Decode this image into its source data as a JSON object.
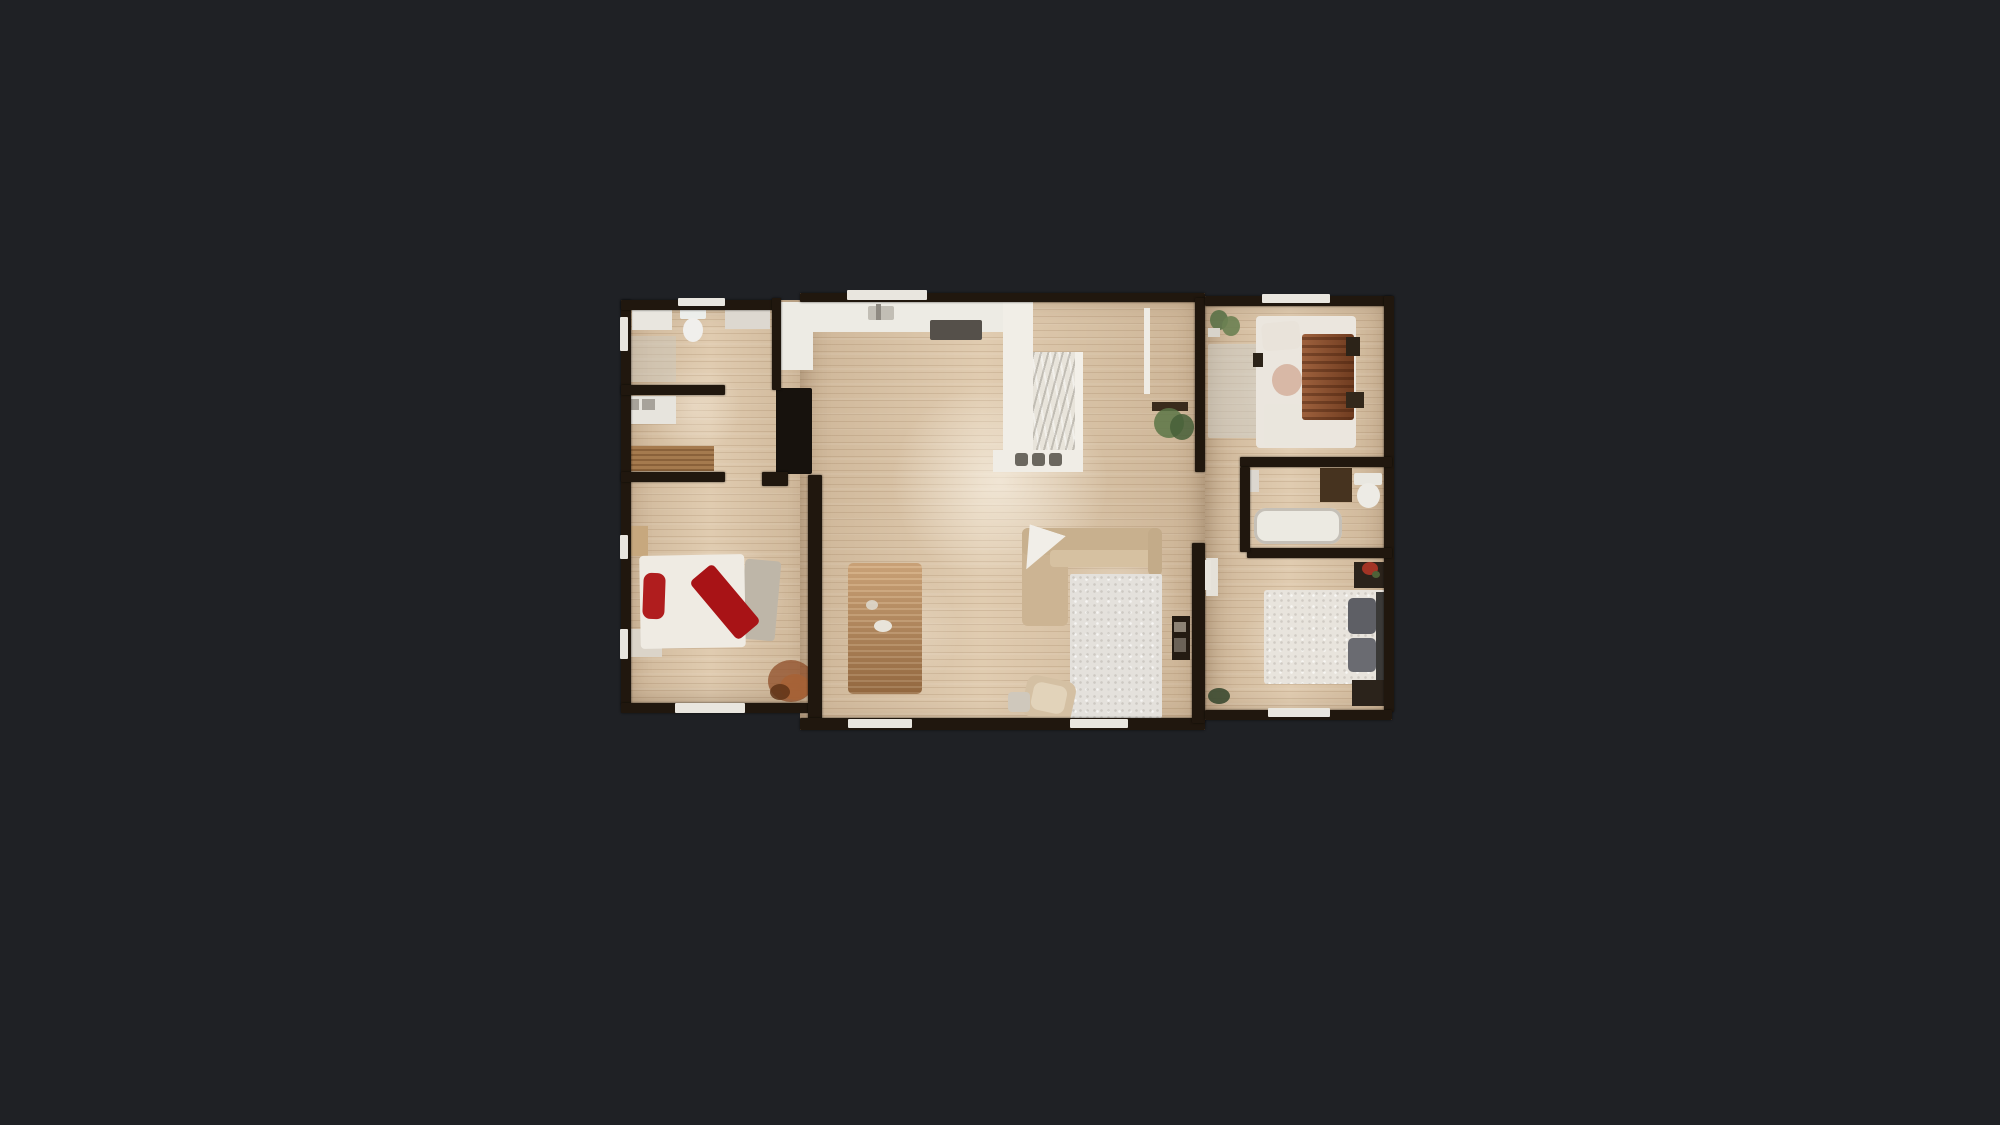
{
  "app": {
    "view": "floor-plan-top-down",
    "background_color": "#1f2125"
  },
  "colors": {
    "bg": "#1f2125",
    "wall": "#20170e",
    "floor": "#dcc6a9",
    "sill": "#e9e6df",
    "accent_red": "#b01d1e",
    "duvet_rust": "#8b4d2a",
    "sofa_beige": "#ccb493",
    "counter_white": "#edebe4"
  },
  "plan": {
    "x": 620,
    "y": 292,
    "w": 775,
    "h": 440
  },
  "scene": {
    "floors": [
      {
        "n": "floor-left-wing",
        "x": 1,
        "y": 8,
        "w": 198,
        "h": 405
      },
      {
        "n": "floor-center-wing",
        "x": 180,
        "y": 1,
        "w": 405,
        "h": 437
      },
      {
        "n": "floor-right-wing",
        "x": 585,
        "y": 4,
        "w": 187,
        "h": 424
      }
    ],
    "glares": [
      {
        "n": "glare-kitchen",
        "x": 230,
        "y": 50,
        "w": 300,
        "h": 280,
        "c": "rgba(255,252,244,0.55)"
      },
      {
        "n": "glare-living",
        "x": 420,
        "y": 220,
        "w": 160,
        "h": 160,
        "c": "rgba(255,250,240,0.35)"
      },
      {
        "n": "glare-bedroom-left",
        "x": 20,
        "y": 230,
        "w": 170,
        "h": 150,
        "c": "rgba(255,248,238,0.38)"
      },
      {
        "n": "glare-laundry",
        "x": 10,
        "y": 50,
        "w": 130,
        "h": 130,
        "c": "rgba(255,248,238,0.30)"
      },
      {
        "n": "glare-bedroom-top-right",
        "x": 595,
        "y": 30,
        "w": 170,
        "h": 130,
        "c": "rgba(255,248,238,0.32)"
      },
      {
        "n": "glare-bedroom-bottom-right",
        "x": 595,
        "y": 290,
        "w": 170,
        "h": 120,
        "c": "rgba(255,248,238,0.30)"
      },
      {
        "n": "glare-dining",
        "x": 210,
        "y": 260,
        "w": 150,
        "h": 160,
        "c": "rgba(255,248,238,0.25)"
      }
    ],
    "furniture": [
      {
        "n": "bathroom1-vanity",
        "x": 12,
        "y": 16,
        "w": 40,
        "h": 22,
        "c": "#e9e6df"
      },
      {
        "n": "toilet1-tank",
        "x": 60,
        "y": 14,
        "w": 26,
        "h": 13,
        "c": "#eceeeb",
        "r": 2
      },
      {
        "n": "toilet1-bowl",
        "x": 63,
        "y": 26,
        "w": 20,
        "h": 24,
        "c": "#f0efec",
        "shape": "ellipse"
      },
      {
        "n": "bathroom1-cabinet",
        "x": 105,
        "y": 13,
        "w": 45,
        "h": 24,
        "c": "#ddd8d0"
      },
      {
        "n": "bathroom1-mat",
        "x": 4,
        "y": 44,
        "w": 52,
        "h": 46,
        "c": "rgba(205,201,192,0.45)"
      },
      {
        "n": "laundry-counter",
        "x": 4,
        "y": 104,
        "w": 52,
        "h": 28,
        "c": "#e7e4dd"
      },
      {
        "n": "washer",
        "x": 6,
        "y": 107,
        "w": 13,
        "h": 11,
        "c": "#a7a29a"
      },
      {
        "n": "dryer",
        "x": 22,
        "y": 107,
        "w": 13,
        "h": 11,
        "c": "#a7a29a"
      },
      {
        "n": "laundry-bench",
        "x": 4,
        "y": 154,
        "w": 90,
        "h": 25,
        "c": "#a57a4e",
        "cls": "woodgrain"
      },
      {
        "n": "bed1-nightstand-top",
        "x": 4,
        "y": 234,
        "w": 24,
        "h": 30,
        "c": "#c7a87e"
      },
      {
        "n": "bed1-nightstand-bottom",
        "x": 10,
        "y": 337,
        "w": 32,
        "h": 28,
        "c": "#dbd4c9"
      },
      {
        "n": "bed1-foot-throw",
        "x": 122,
        "y": 268,
        "w": 36,
        "h": 80,
        "c": "#beb6a8",
        "rot": 5,
        "r": 4
      },
      {
        "n": "bed1-mattress",
        "x": 20,
        "y": 263,
        "w": 105,
        "h": 93,
        "c": "#efebe3",
        "r": 4,
        "rot": -1
      },
      {
        "n": "bed1-red-pillow",
        "x": 23,
        "y": 281,
        "w": 22,
        "h": 46,
        "c": "#b01d1e",
        "r": 8,
        "rot": 2
      },
      {
        "n": "bed1-red-blanket",
        "x": 90,
        "y": 272,
        "w": 30,
        "h": 76,
        "c": "#a81316",
        "r": 5,
        "rot": -40
      },
      {
        "n": "bed1-plant-a",
        "x": 148,
        "y": 368,
        "w": 46,
        "h": 42,
        "c": "#8f4d28",
        "shape": "ellipse",
        "op": 0.75
      },
      {
        "n": "bed1-plant-b",
        "x": 160,
        "y": 382,
        "w": 30,
        "h": 26,
        "c": "#a86234",
        "shape": "ellipse",
        "op": 0.8
      },
      {
        "n": "bed1-plant-c",
        "x": 150,
        "y": 392,
        "w": 20,
        "h": 16,
        "c": "#5f3418",
        "shape": "ellipse",
        "op": 0.85
      },
      {
        "n": "kitchen-counter",
        "x": 158,
        "y": 10,
        "w": 230,
        "h": 30,
        "c": "#edebe4"
      },
      {
        "n": "kitchen-counter-left",
        "x": 161,
        "y": 10,
        "w": 32,
        "h": 68,
        "c": "#edebe4"
      },
      {
        "n": "kitchen-sink",
        "x": 248,
        "y": 14,
        "w": 26,
        "h": 14,
        "c": "#c2beb5",
        "r": 2
      },
      {
        "n": "kitchen-faucet",
        "x": 256,
        "y": 12,
        "w": 5,
        "h": 16,
        "c": "#8f8a82"
      },
      {
        "n": "cooktop",
        "x": 310,
        "y": 28,
        "w": 52,
        "h": 20,
        "c": "#55504a",
        "r": 2
      },
      {
        "n": "refrigerator",
        "x": 156,
        "y": 96,
        "w": 36,
        "h": 86,
        "c": "#17120d",
        "r": 2
      },
      {
        "n": "peninsula-column",
        "x": 383,
        "y": 10,
        "w": 30,
        "h": 162,
        "c": "#f1eee7"
      },
      {
        "n": "peninsula-counter",
        "x": 413,
        "y": 60,
        "w": 48,
        "h": 118,
        "c": "#e8e4db",
        "cls": "marble"
      },
      {
        "n": "peninsula-rim",
        "x": 455,
        "y": 60,
        "w": 8,
        "h": 118,
        "c": "#f3f0e9"
      },
      {
        "n": "peninsula-base",
        "x": 373,
        "y": 158,
        "w": 90,
        "h": 22,
        "c": "#f0ede6"
      },
      {
        "n": "stool-1",
        "x": 395,
        "y": 161,
        "w": 13,
        "h": 13,
        "c": "#6b675f",
        "r": 3
      },
      {
        "n": "stool-2",
        "x": 412,
        "y": 161,
        "w": 13,
        "h": 13,
        "c": "#6b675f",
        "r": 3
      },
      {
        "n": "stool-3",
        "x": 429,
        "y": 161,
        "w": 13,
        "h": 13,
        "c": "#6b675f",
        "r": 3
      },
      {
        "n": "entry-door-leaf",
        "x": 524,
        "y": 16,
        "w": 6,
        "h": 86,
        "c": "#efece5",
        "z": 7
      },
      {
        "n": "console-table",
        "x": 532,
        "y": 110,
        "w": 36,
        "h": 9,
        "c": "#3a2b1c"
      },
      {
        "n": "console-plant-a",
        "x": 534,
        "y": 116,
        "w": 30,
        "h": 30,
        "c": "#5c7647",
        "shape": "ellipse",
        "op": 0.85
      },
      {
        "n": "console-plant-b",
        "x": 550,
        "y": 122,
        "w": 24,
        "h": 26,
        "c": "#465f38",
        "shape": "ellipse",
        "op": 0.85
      },
      {
        "n": "dining-table",
        "x": 228,
        "y": 271,
        "w": 74,
        "h": 131,
        "c": "#a87a4e",
        "r": 5,
        "cls": "tablegrain"
      },
      {
        "n": "dining-centerpiece",
        "x": 254,
        "y": 328,
        "w": 18,
        "h": 12,
        "c": "#e8e4da",
        "shape": "ellipse"
      },
      {
        "n": "dining-napkin",
        "x": 246,
        "y": 308,
        "w": 12,
        "h": 10,
        "c": "#ddd7cb",
        "shape": "ellipse",
        "op": 0.9
      },
      {
        "n": "sofa-chaise",
        "x": 402,
        "y": 236,
        "w": 46,
        "h": 98,
        "c": "#ccb493",
        "r": 6
      },
      {
        "n": "sofa-back",
        "x": 402,
        "y": 236,
        "w": 140,
        "h": 27,
        "c": "#c8b08e",
        "r": 6
      },
      {
        "n": "sofa-seat",
        "x": 430,
        "y": 258,
        "w": 108,
        "h": 17,
        "c": "#d6c1a1",
        "r": 4
      },
      {
        "n": "sofa-arm",
        "x": 528,
        "y": 236,
        "w": 14,
        "h": 48,
        "c": "#c3ab89",
        "r": 6
      },
      {
        "n": "sofa-throw-blanket",
        "x": 402,
        "y": 237,
        "w": 38,
        "h": 44,
        "c": "#f1eee8",
        "rot": 18,
        "clip": "polygon(0 0, 100% 0, 28% 100%)"
      },
      {
        "n": "area-rug",
        "x": 450,
        "y": 282,
        "w": 92,
        "h": 144,
        "c": "#e4e1dc",
        "r": 2,
        "cls": "rugtex"
      },
      {
        "n": "pouf",
        "x": 404,
        "y": 386,
        "w": 50,
        "h": 42,
        "c": "#d4c0a3",
        "r": 10,
        "rot": 12
      },
      {
        "n": "pouf-top",
        "x": 412,
        "y": 392,
        "w": 34,
        "h": 28,
        "c": "#e2d3ba",
        "r": 8,
        "rot": 12
      },
      {
        "n": "side-table",
        "x": 388,
        "y": 400,
        "w": 22,
        "h": 20,
        "c": "#cfc8bc",
        "r": 4
      },
      {
        "n": "media-console",
        "x": 552,
        "y": 324,
        "w": 18,
        "h": 44,
        "c": "#241b12"
      },
      {
        "n": "media-item-a",
        "x": 554,
        "y": 330,
        "w": 12,
        "h": 10,
        "c": "#8d8375"
      },
      {
        "n": "media-item-b",
        "x": 554,
        "y": 346,
        "w": 12,
        "h": 14,
        "c": "#6b6257"
      },
      {
        "n": "bed3-rug",
        "x": 588,
        "y": 52,
        "w": 50,
        "h": 94,
        "c": "rgba(208,210,205,0.5)",
        "r": 2
      },
      {
        "n": "bed3-mattress",
        "x": 636,
        "y": 24,
        "w": 100,
        "h": 132,
        "c": "#ebe6de",
        "r": 4
      },
      {
        "n": "bed3-rust-duvet",
        "x": 682,
        "y": 42,
        "w": 52,
        "h": 86,
        "c": "#8b4d2a",
        "r": 3,
        "cls": "duvetgrain"
      },
      {
        "n": "bed3-pillow",
        "x": 642,
        "y": 30,
        "w": 38,
        "h": 28,
        "c": "#e9e3da",
        "r": 6,
        "rot": -5
      },
      {
        "n": "bed3-round-pillow",
        "x": 652,
        "y": 72,
        "w": 30,
        "h": 32,
        "c": "#d8b8a6",
        "shape": "ellipse"
      },
      {
        "n": "bed3-bench",
        "x": 644,
        "y": 112,
        "w": 36,
        "h": 42,
        "c": "#eae6dd",
        "r": 3
      },
      {
        "n": "bed3-nightstand-a",
        "x": 726,
        "y": 45,
        "w": 14,
        "h": 19,
        "c": "#2c2318"
      },
      {
        "n": "bed3-nightstand-b",
        "x": 726,
        "y": 100,
        "w": 18,
        "h": 16,
        "c": "#33281b"
      },
      {
        "n": "bed3-dark-item",
        "x": 633,
        "y": 61,
        "w": 10,
        "h": 14,
        "c": "#2c2318"
      },
      {
        "n": "bed3-plant-a",
        "x": 590,
        "y": 18,
        "w": 18,
        "h": 20,
        "c": "#5a7147",
        "shape": "ellipse",
        "op": 0.9
      },
      {
        "n": "bed3-plant-b",
        "x": 602,
        "y": 24,
        "w": 18,
        "h": 20,
        "c": "#6b8152",
        "shape": "ellipse",
        "op": 0.9
      },
      {
        "n": "bed3-planter",
        "x": 588,
        "y": 36,
        "w": 12,
        "h": 9,
        "c": "#d8d4cb"
      },
      {
        "n": "bathtub",
        "x": 634,
        "y": 216,
        "w": 88,
        "h": 36,
        "c": "#eceae2",
        "r": 12,
        "cls": "tubrim"
      },
      {
        "n": "bathroom2-vanity",
        "x": 700,
        "y": 176,
        "w": 32,
        "h": 34,
        "c": "#46331f"
      },
      {
        "n": "toilet2-tank",
        "x": 734,
        "y": 181,
        "w": 28,
        "h": 12,
        "c": "#e9e7e0",
        "r": 2
      },
      {
        "n": "toilet2-bowl",
        "x": 737,
        "y": 191,
        "w": 23,
        "h": 25,
        "c": "#edebe5",
        "shape": "ellipse"
      },
      {
        "n": "bathroom2-shelf",
        "x": 630,
        "y": 178,
        "w": 9,
        "h": 22,
        "c": "#dcd7cf"
      },
      {
        "n": "bed2-dresser",
        "x": 586,
        "y": 266,
        "w": 12,
        "h": 38,
        "c": "#e5e1d9"
      },
      {
        "n": "bed2-door-leaf",
        "x": 585,
        "y": 268,
        "w": 6,
        "h": 30,
        "c": "#e8e4dc",
        "z": 7
      },
      {
        "n": "bed2-mattress",
        "x": 644,
        "y": 298,
        "w": 126,
        "h": 94,
        "c": "#e8e4dd",
        "r": 3,
        "cls": "rugtex"
      },
      {
        "n": "bed2-pillow-a",
        "x": 728,
        "y": 306,
        "w": 28,
        "h": 36,
        "c": "#5e5f65",
        "r": 5
      },
      {
        "n": "bed2-pillow-b",
        "x": 728,
        "y": 346,
        "w": 28,
        "h": 34,
        "c": "#6a6b71",
        "r": 5
      },
      {
        "n": "bed2-headboard",
        "x": 756,
        "y": 300,
        "w": 14,
        "h": 92,
        "c": "#3a3937"
      },
      {
        "n": "bed2-nightstand-top",
        "x": 734,
        "y": 270,
        "w": 34,
        "h": 26,
        "c": "#2b231b"
      },
      {
        "n": "bed2-flowers",
        "x": 742,
        "y": 270,
        "w": 16,
        "h": 13,
        "c": "#a23425",
        "shape": "ellipse"
      },
      {
        "n": "bed2-flowers-green",
        "x": 752,
        "y": 279,
        "w": 8,
        "h": 7,
        "c": "#4e6238",
        "shape": "ellipse"
      },
      {
        "n": "bed2-nightstand-bottom",
        "x": 732,
        "y": 388,
        "w": 36,
        "h": 26,
        "c": "#2b231b"
      },
      {
        "n": "bed2-plant",
        "x": 588,
        "y": 396,
        "w": 22,
        "h": 16,
        "c": "#3c4a31",
        "shape": "ellipse",
        "op": 0.9
      }
    ],
    "walls": [
      {
        "n": "wall-left-outer",
        "x": 1,
        "y": 8,
        "w": 10,
        "h": 405
      },
      {
        "n": "wall-left-top",
        "x": 1,
        "y": 8,
        "w": 156,
        "h": 10
      },
      {
        "n": "wall-left-bottom",
        "x": 1,
        "y": 411,
        "w": 198,
        "h": 10
      },
      {
        "n": "wall-bathroom1-divider",
        "x": 1,
        "y": 93,
        "w": 104,
        "h": 10
      },
      {
        "n": "wall-laundry-divider",
        "x": 1,
        "y": 180,
        "w": 104,
        "h": 10
      },
      {
        "n": "wall-kitchen-left",
        "x": 152,
        "y": 6,
        "w": 9,
        "h": 92
      },
      {
        "n": "wall-bed1-door-stub",
        "x": 142,
        "y": 180,
        "w": 26,
        "h": 14
      },
      {
        "n": "wall-bed1-right",
        "x": 188,
        "y": 183,
        "w": 14,
        "h": 245
      },
      {
        "n": "wall-center-top",
        "x": 180,
        "y": 1,
        "w": 405,
        "h": 9
      },
      {
        "n": "wall-center-bottom",
        "x": 180,
        "y": 426,
        "w": 405,
        "h": 12
      },
      {
        "n": "wall-center-right-upper",
        "x": 575,
        "y": 6,
        "w": 10,
        "h": 174
      },
      {
        "n": "wall-center-right-lower",
        "x": 572,
        "y": 251,
        "w": 13,
        "h": 180
      },
      {
        "n": "wall-right-top",
        "x": 585,
        "y": 4,
        "w": 187,
        "h": 10
      },
      {
        "n": "wall-right-outer",
        "x": 764,
        "y": 4,
        "w": 10,
        "h": 416
      },
      {
        "n": "wall-right-bottom",
        "x": 585,
        "y": 418,
        "w": 187,
        "h": 10
      },
      {
        "n": "wall-hall-divider",
        "x": 620,
        "y": 165,
        "w": 152,
        "h": 10
      },
      {
        "n": "wall-bed2-top",
        "x": 627,
        "y": 256,
        "w": 145,
        "h": 10
      },
      {
        "n": "wall-bathroom2-left",
        "x": 620,
        "y": 175,
        "w": 10,
        "h": 85
      }
    ],
    "sills": [
      {
        "n": "window-bathroom1-top",
        "x": 58,
        "y": 6,
        "w": 47,
        "h": 8
      },
      {
        "n": "window-left-upper",
        "x": 0,
        "y": 25,
        "w": 8,
        "h": 34
      },
      {
        "n": "window-bed1-left-a",
        "x": 0,
        "y": 243,
        "w": 8,
        "h": 24
      },
      {
        "n": "window-bed1-left-b",
        "x": 0,
        "y": 337,
        "w": 8,
        "h": 30
      },
      {
        "n": "window-bed1-bottom",
        "x": 55,
        "y": 411,
        "w": 70,
        "h": 10
      },
      {
        "n": "window-kitchen-hood",
        "x": 227,
        "y": -2,
        "w": 80,
        "h": 10
      },
      {
        "n": "window-center-bottom-a",
        "x": 228,
        "y": 427,
        "w": 64,
        "h": 9
      },
      {
        "n": "window-center-bottom-b",
        "x": 450,
        "y": 427,
        "w": 58,
        "h": 9
      },
      {
        "n": "window-bed3-top",
        "x": 642,
        "y": 2,
        "w": 68,
        "h": 9
      },
      {
        "n": "window-bed2-bottom",
        "x": 648,
        "y": 416,
        "w": 62,
        "h": 9
      }
    ]
  }
}
